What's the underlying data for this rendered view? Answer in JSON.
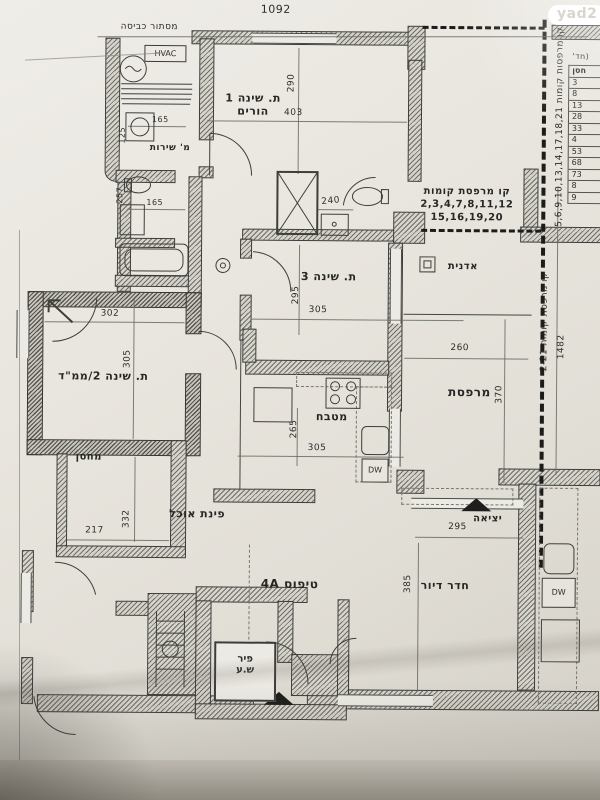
{
  "logo": "yad2",
  "dims": {
    "total_w": "1092",
    "total_h": "1482",
    "b1_w": "403",
    "b1_h": "290",
    "b3_w": "305",
    "b3_h": "295",
    "mamad_w": "302",
    "mamad_h": "305",
    "storage_w": "217",
    "storage_h": "332",
    "kitchen_w": "305",
    "kitchen_h": "265",
    "balcony_w": "260",
    "balcony_h": "370",
    "living_w": "295",
    "living_h": "385",
    "bath_w": "240",
    "swc_w": "165",
    "swc_h": "125",
    "bath2_w": "165",
    "bath2_h": "257"
  },
  "labels": {
    "laundry": "מסתור כביסה",
    "hvac": "HVAC",
    "service_wc": "מ' שירות",
    "bedroom1_l1": "ת. שינה 1",
    "bedroom1_l2": "הורים",
    "bedroom3": "ת. שינה 3",
    "mamad": "ת. שינה 2/ממ\"ד",
    "storage": "מחסן",
    "dining": "פינת אוכל",
    "kitchen": "מטבח",
    "balcony": "מרפסת",
    "planter": "אדנית",
    "living": "חדר דיור",
    "exit": "יציאה",
    "unit_type": "טיפוס 4A",
    "shaft_l1": "פיר",
    "shaft_l2": "ש.ע",
    "dw": "DW",
    "neighbor_dw": "DW",
    "balcony_line_a1": "קו מרפסת קומות",
    "balcony_line_a2": "2,3,4,7,8,11,12",
    "balcony_line_a3": "15,16,19,20",
    "balcony_line_b": "קו מרפסות קומות 5,6,9,10,13,14,17,18,21",
    "balcony_line_c": "קו מרפסת קומות 2-21"
  },
  "side_table": {
    "title": "(חד'",
    "header": "חסן",
    "values": [
      "3",
      "8",
      "13",
      "28",
      "33",
      "4",
      "53",
      "68",
      "73",
      "8",
      "9"
    ]
  }
}
